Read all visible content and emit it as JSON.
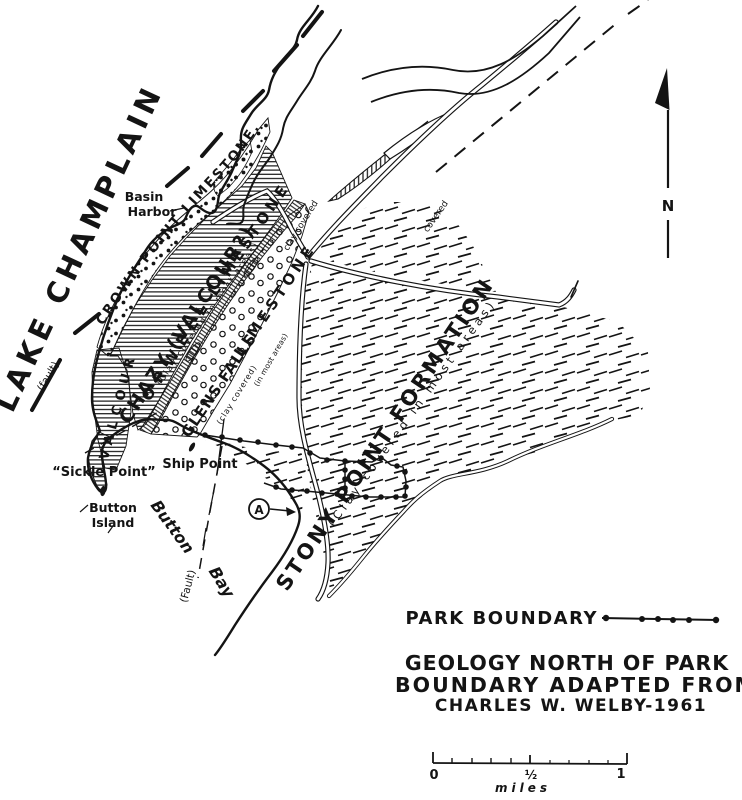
{
  "colors": {
    "ink": "#141414",
    "paper": "#ffffff"
  },
  "map": {
    "lake_label": "LAKE CHAMPLAIN",
    "fault_lake": "(fault)",
    "fault_bay": "(Fault)",
    "basin_harbor": {
      "line1": "Basin",
      "line2": "Harbor"
    },
    "sickle_point": "“Sickle Point”",
    "ship_point": "Ship Point",
    "button_island": {
      "line1": "Button",
      "line2": "Island"
    },
    "button_bay": {
      "word1": "Button",
      "word2": "Bay"
    },
    "marker_a": "A",
    "north_label": "N",
    "road_note_clay_covered": "clay covered",
    "road_note_covered": "covered",
    "formations": {
      "crown_point": "CROWN POINT LIMESTONE.",
      "valcour": "VALCOUR",
      "chazy": "CHAZY (VALCOUR?)",
      "chazy_note": "(Clay covered in most areas)",
      "orwell_word1": "ORWELL",
      "orwell_word2": "LIMESTONE",
      "glens_falls_word1": "GLENS FALLS",
      "glens_falls_word2": "LIMESTONE",
      "glens_falls_note1": "(clay covered)",
      "glens_falls_note2": "(in most areas)",
      "stony_point": "STONY POINT FORMATION",
      "stony_point_note": "(Clay covered in most areas)"
    }
  },
  "legend": {
    "park_boundary_label": "PARK BOUNDARY"
  },
  "title": {
    "line1": "GEOLOGY NORTH OF PARK",
    "line2": "BOUNDARY ADAPTED FROM",
    "line3": "CHARLES W. WELBY-1961"
  },
  "scale_bar": {
    "start": "0",
    "half": "½",
    "end": "1",
    "unit": "miles"
  }
}
